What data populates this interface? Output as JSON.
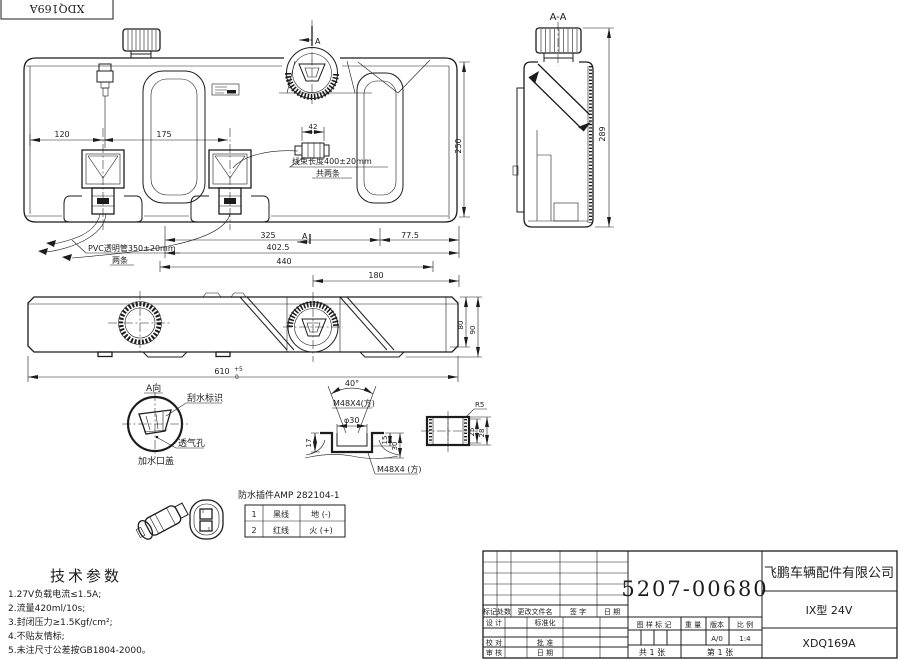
{
  "drawing": {
    "corner_label": "XDQ169A",
    "front": {
      "d120": "120",
      "d175": "175",
      "d42": "42",
      "d250": "250",
      "d325": "325",
      "d402_5": "402.5",
      "d77_5": "77.5",
      "d440": "440",
      "d180": "180",
      "marker_a": "A",
      "harness1": "线束长度400±20mm",
      "harness2": "共两条",
      "pvc1": "PVC透明管350±20mm",
      "pvc2": "两条"
    },
    "section": {
      "title": "A-A",
      "d289": "289"
    },
    "bottom": {
      "d610": "610",
      "tol_up": "+5",
      "tol_dn": "0",
      "d80": "80",
      "d90": "90"
    },
    "view_a": {
      "title": "A向",
      "wiper": "刮水标识",
      "vent": "透气孔",
      "cap": "加水口盖"
    },
    "thread": {
      "angle": "40°",
      "m48_top": "M48X4(方)",
      "dia": "φ30",
      "d17": "17",
      "d15": "15",
      "d30": "30",
      "m48_bottom": "M48X4 (方)",
      "r5": "R5",
      "d25": "25",
      "d28": "28"
    },
    "connector": {
      "title": "防水插件AMP 282104-1",
      "table": [
        [
          "1",
          "黑线",
          "地 (-)"
        ],
        [
          "2",
          "红线",
          "火 (+)"
        ]
      ]
    },
    "tech": {
      "title": "技术参数",
      "items": [
        "1.27V负载电流≤1.5A;",
        "2.流量420ml/10s;",
        "3.封闭压力≥1.5Kgf/cm²;",
        "4.不贴友情标;",
        "5.未注尺寸公差按GB1804-2000。"
      ]
    },
    "tb": {
      "part_number": "5207-00680",
      "company": "飞鹏车辆配件有限公司",
      "model": "IX型 24V",
      "drawing_no": "XDQ169A",
      "h_mark": "标记",
      "h_count": "处数",
      "h_file": "更改文件名",
      "h_sign": "签 字",
      "h_date": "日 期",
      "design": "设 计",
      "standardize": "标准化",
      "check": "校 对",
      "approve": "批 准",
      "review": "审 核",
      "date2": "日 期",
      "mark_label": "图 样 标 记",
      "weight_label": "重 量",
      "version_label": "版本",
      "scale_label": "比 例",
      "version_value": "A/0",
      "scale_value": "1:4",
      "sheets_total": "共 1 张",
      "sheet_no": "第 1 张"
    }
  }
}
